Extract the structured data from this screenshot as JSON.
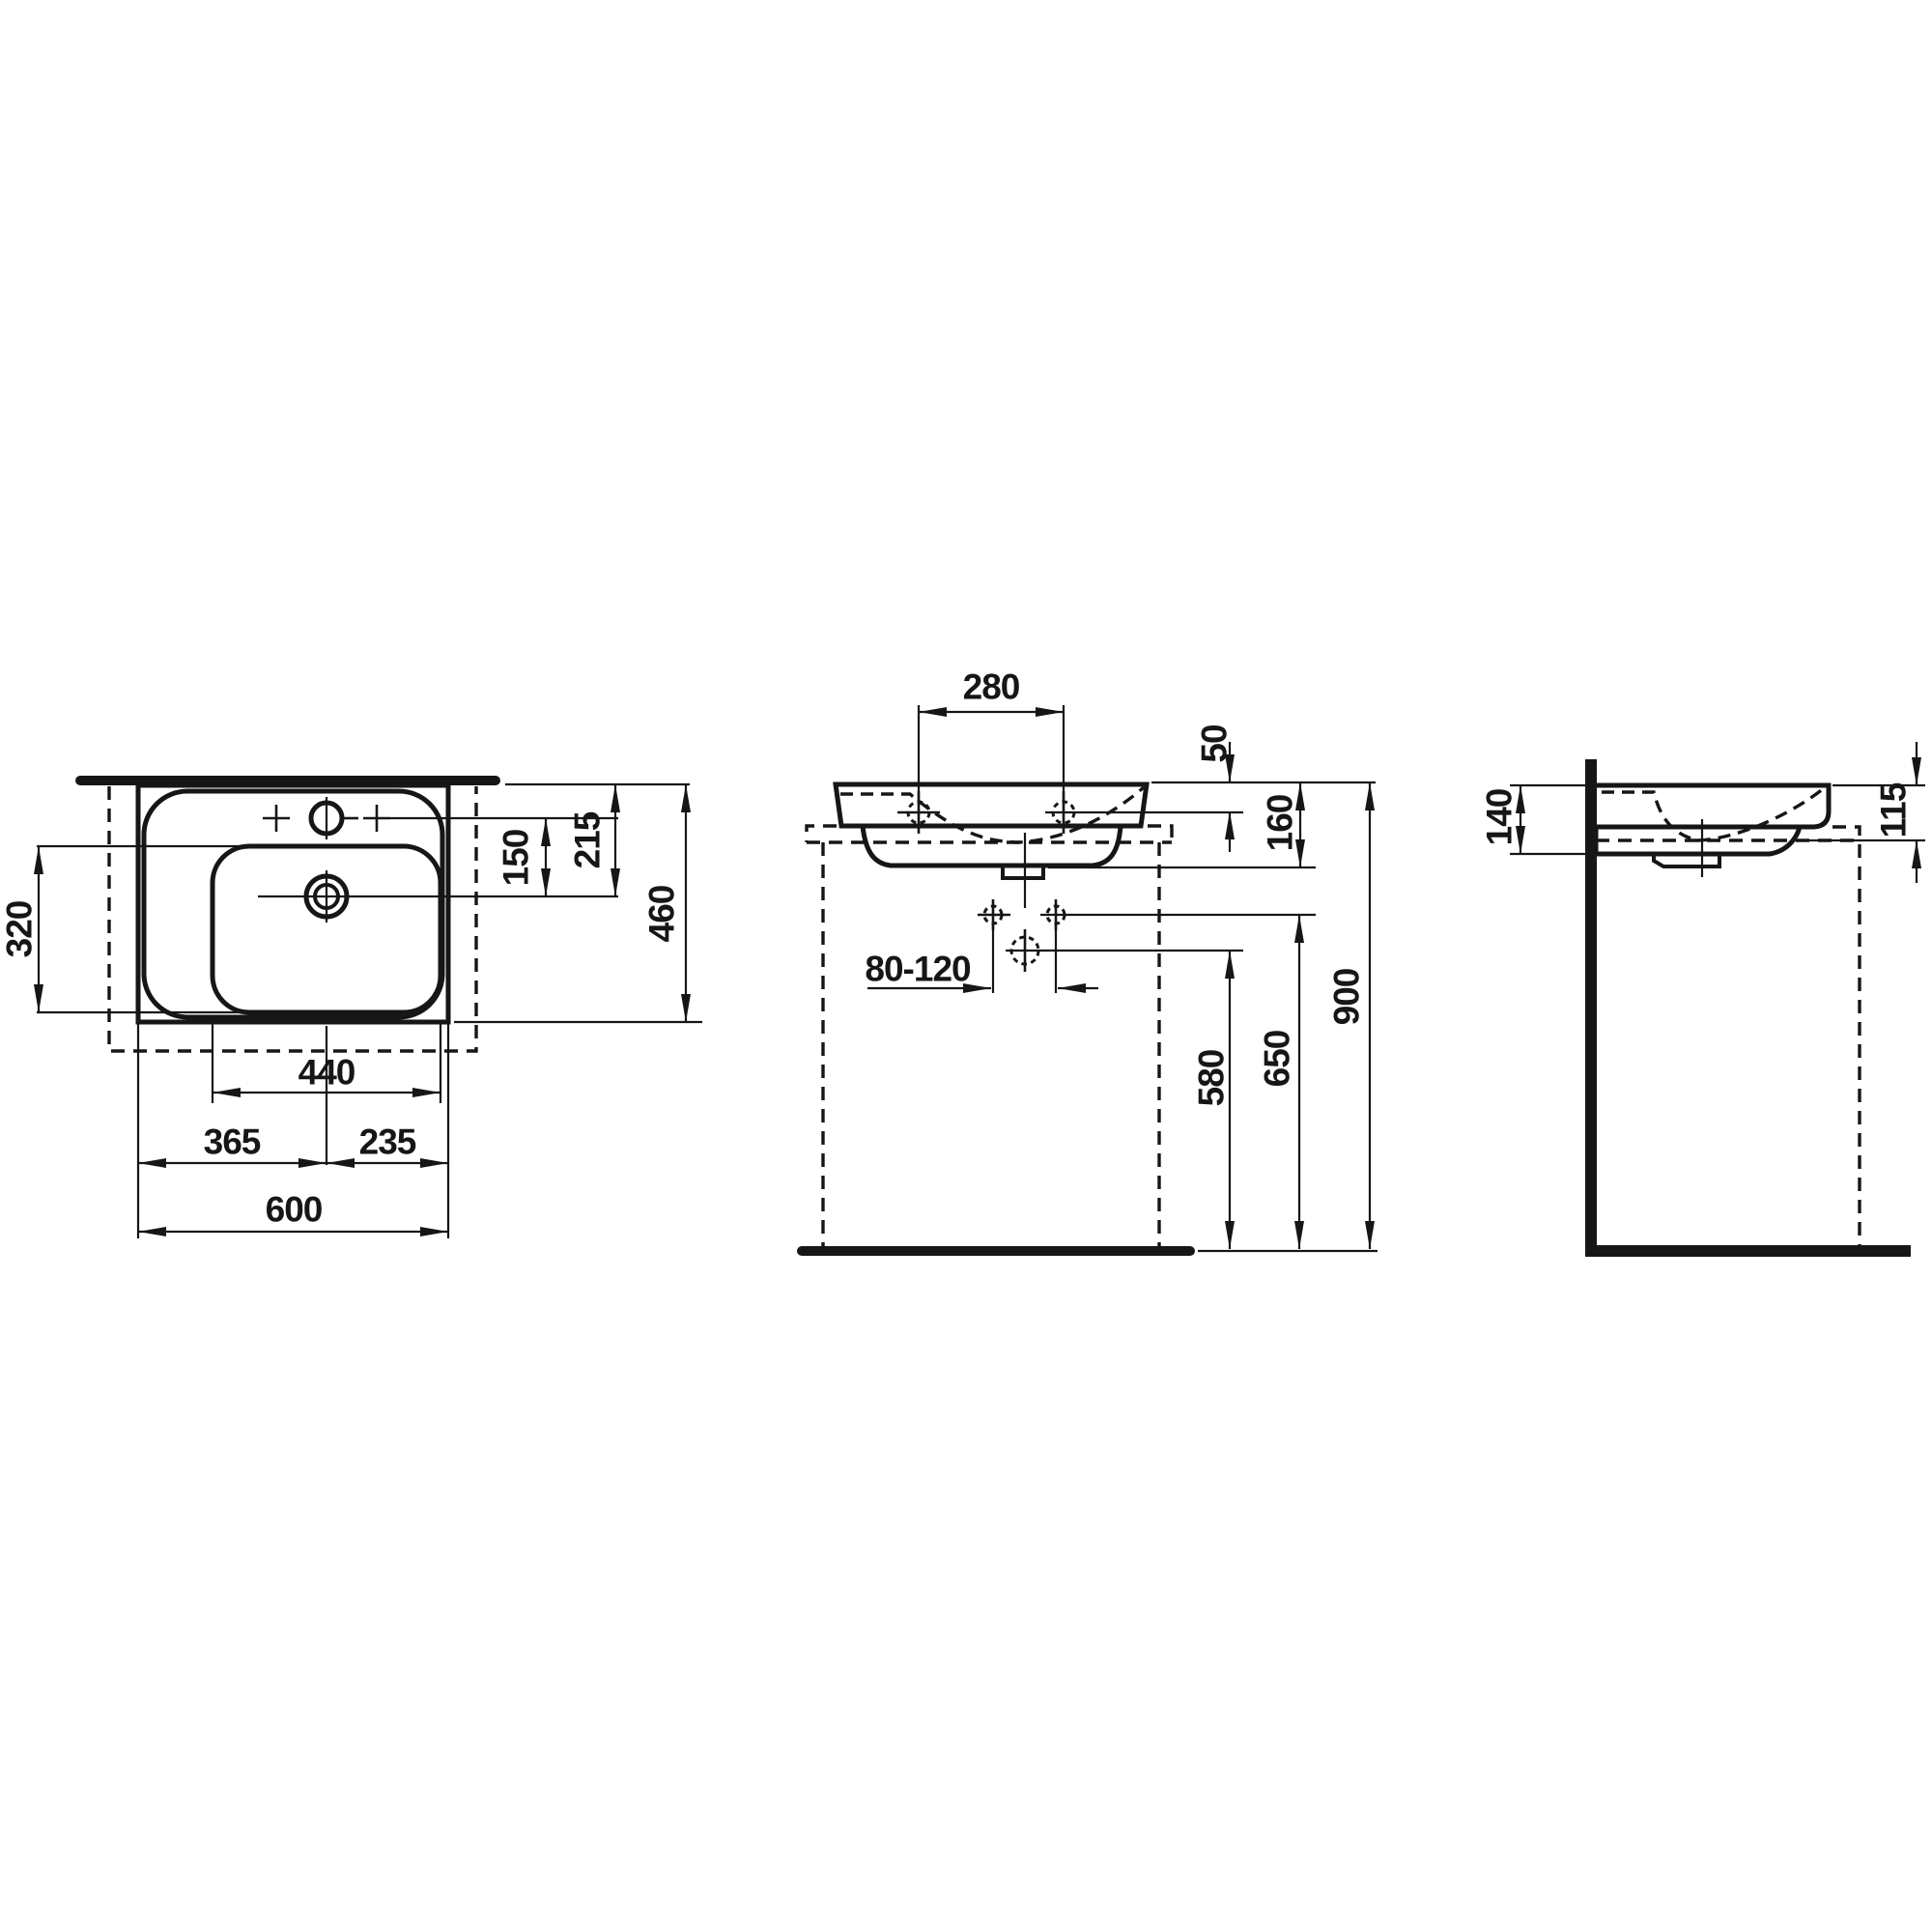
{
  "drawing": {
    "units": "mm",
    "colors": {
      "line": "#161616",
      "background": "#ffffff"
    },
    "dims": {
      "plan": {
        "overall_width": "600",
        "drain_from_left": "365",
        "drain_from_right": "235",
        "basin_width": "440",
        "basin_depth": "320",
        "tap_to_drain": "150",
        "rim_to_drain": "215",
        "overall_depth": "460"
      },
      "front": {
        "fixing_hole_spacing": "280",
        "rim_to_fixing_holes": "50",
        "basin_height": "160",
        "drain_offset_range": "80-120",
        "drain_height": "580",
        "connection_height": "650",
        "rim_height": "900"
      },
      "side": {
        "wall_side_height": "140",
        "front_edge_height": "115"
      }
    }
  }
}
